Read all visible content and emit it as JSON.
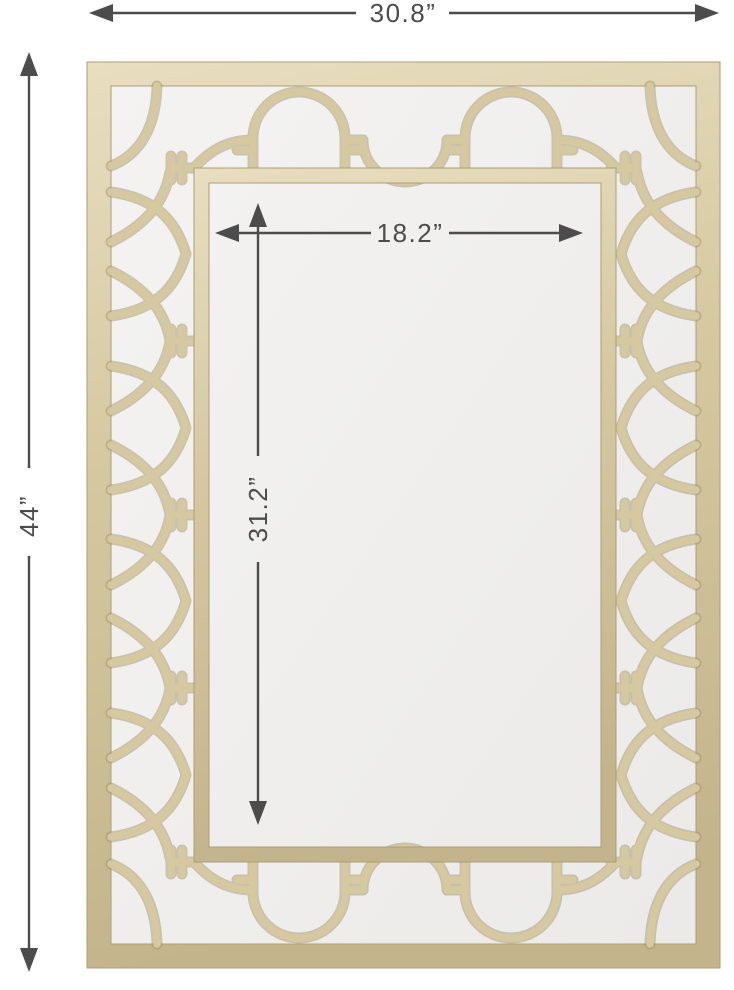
{
  "diagram": {
    "type": "product-dimension-diagram",
    "product": "quatrefoil-trellis-wall-mirror",
    "dimensions": {
      "overall_width": "30.8”",
      "overall_height": "44”",
      "inner_width": "18.2”",
      "inner_height": "31.2”"
    },
    "colors": {
      "frame_gold_light": "#e6dcbc",
      "frame_gold": "#d3c69e",
      "frame_gold_dark": "#a3956e",
      "mirror_glass": "#f1f0ee",
      "dimension_gray": "#4c4c4c",
      "background": "#ffffff"
    }
  }
}
